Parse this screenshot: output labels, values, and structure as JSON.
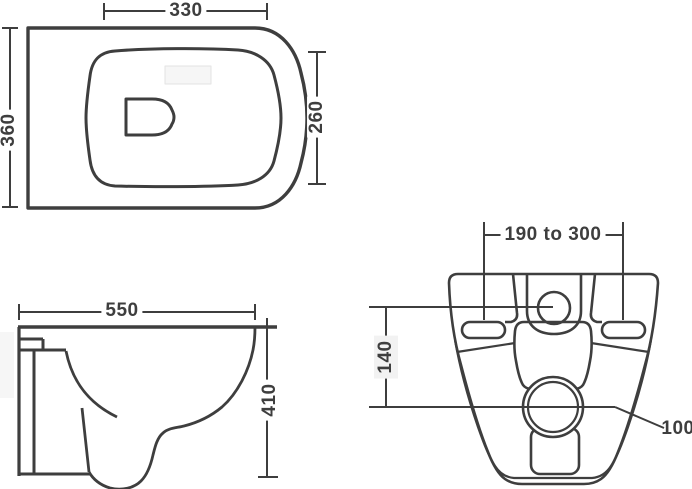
{
  "document": {
    "type": "technical dimension drawing",
    "subject": "wall-hung toilet pan, three orthographic views"
  },
  "colors": {
    "line": "#3e3e3e",
    "dimension_text": "#3e3e3e",
    "background": "#ffffff",
    "watermark": "#f6f6f6",
    "label_box": "#f2f2f2"
  },
  "top_view": {
    "dims": {
      "rim_width": "330",
      "overall_depth": "360",
      "seat_depth": "260"
    }
  },
  "side_view": {
    "dims": {
      "projection": "550",
      "height": "410"
    }
  },
  "back_view": {
    "dims": {
      "fixing_centres": "190 to 300",
      "inlet_to_outlet": "140",
      "outlet_dia": "100"
    }
  }
}
